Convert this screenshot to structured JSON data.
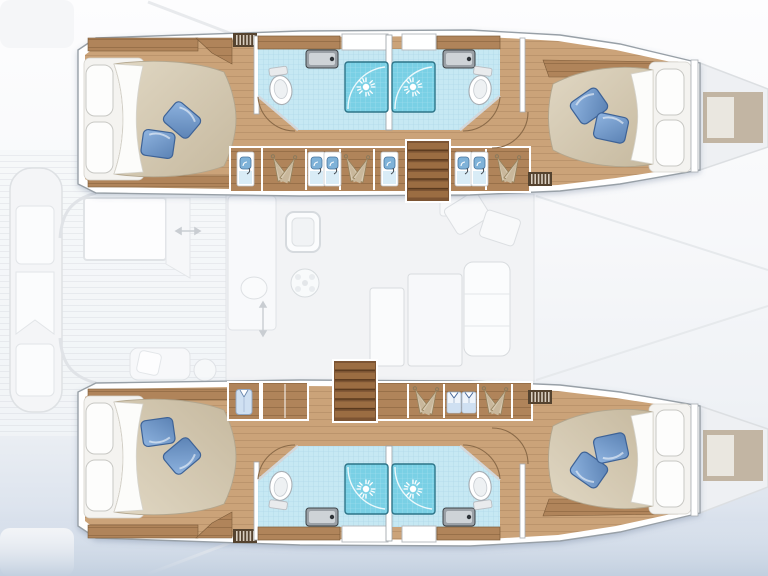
{
  "meta": {
    "type": "yacht-floorplan",
    "vessel": "catamaran",
    "view": "hull-deck-plan-top-view",
    "canvas": {
      "width": 768,
      "height": 576
    }
  },
  "port_hull": {
    "position": "top",
    "aft_cabin": {
      "bed": "double",
      "white_pillows": 2,
      "blue_throw_pillows": 2,
      "vent_grille": true,
      "washstand": true
    },
    "aft_bathroom": {
      "shower": true,
      "toilet": true,
      "sink": true,
      "door_arc": true
    },
    "fwd_bathroom": {
      "shower": true,
      "toilet": true,
      "sink": true,
      "door_arc": true
    },
    "corridor_lockers": {
      "hanger_pairs": 3,
      "washbasin_panels": 4
    },
    "companionway_stairs": true,
    "fwd_cabin": {
      "bed": "double",
      "white_pillows": 2,
      "blue_throw_pillows": 2,
      "vent_grille": true,
      "closet": true
    },
    "bow_hatch": true
  },
  "starboard_hull": {
    "position": "bottom",
    "aft_cabin": {
      "bed": "double",
      "white_pillows": 2,
      "blue_throw_pillows": 2,
      "vent_grille": true,
      "hanging_shirt_locker": true,
      "cabinet": true
    },
    "aft_bathroom": {
      "shower": true,
      "toilet": true,
      "sink": true,
      "door_arc": true
    },
    "fwd_bathroom": {
      "shower": true,
      "toilet": true,
      "sink": true,
      "door_arc": true
    },
    "corridor_lockers": {
      "hanger_pairs": 2,
      "folded_shirts": 2
    },
    "companionway_stairs": true,
    "fwd_cabin": {
      "bed": "double",
      "white_pillows": 2,
      "blue_throw_pillows": 2,
      "vent_grille": true,
      "closet": true
    },
    "bow_hatch": true
  },
  "saloon": {
    "state": "faded-background",
    "galley": [
      "counter",
      "sink",
      "stove",
      "basin"
    ],
    "dinette": [
      "table",
      "sofa",
      "chairs"
    ],
    "cockpit_aft": [
      "bench",
      "table",
      "arrow-marker"
    ]
  },
  "palette": {
    "wood_floor_light": "#cba379",
    "wood_floor_dark": "#b78f62",
    "wood_trim_light": "#b0845a",
    "wood_trim_dark": "#96703f",
    "stair_wood": "#7c5433",
    "stair_tread": "#9b6d42",
    "duvet_light": "#e0d7c3",
    "duvet_dark": "#c6b99f",
    "pillow_blue_light": "#8fb4e0",
    "pillow_blue_dark": "#5b82b4",
    "tile_floor": "#c6e8f3",
    "tile_grid": "#a6d6e7",
    "shower_fill": "#79d0e5",
    "shower_grid": "#5fc2d9",
    "hull_stroke": "#98a0a7",
    "faded_fill": "#f2f3f5",
    "faded_line": "#dde0e4",
    "hatch_tan": "#c2b5a3",
    "hatch_inner": "#eae7e0",
    "water_light": "#e9eef5",
    "water_dark": "#c2cfdf",
    "wall_white": "#ffffff",
    "shirt_blue": "#cfe0f2",
    "basin_blue": "#7fb2d8"
  }
}
